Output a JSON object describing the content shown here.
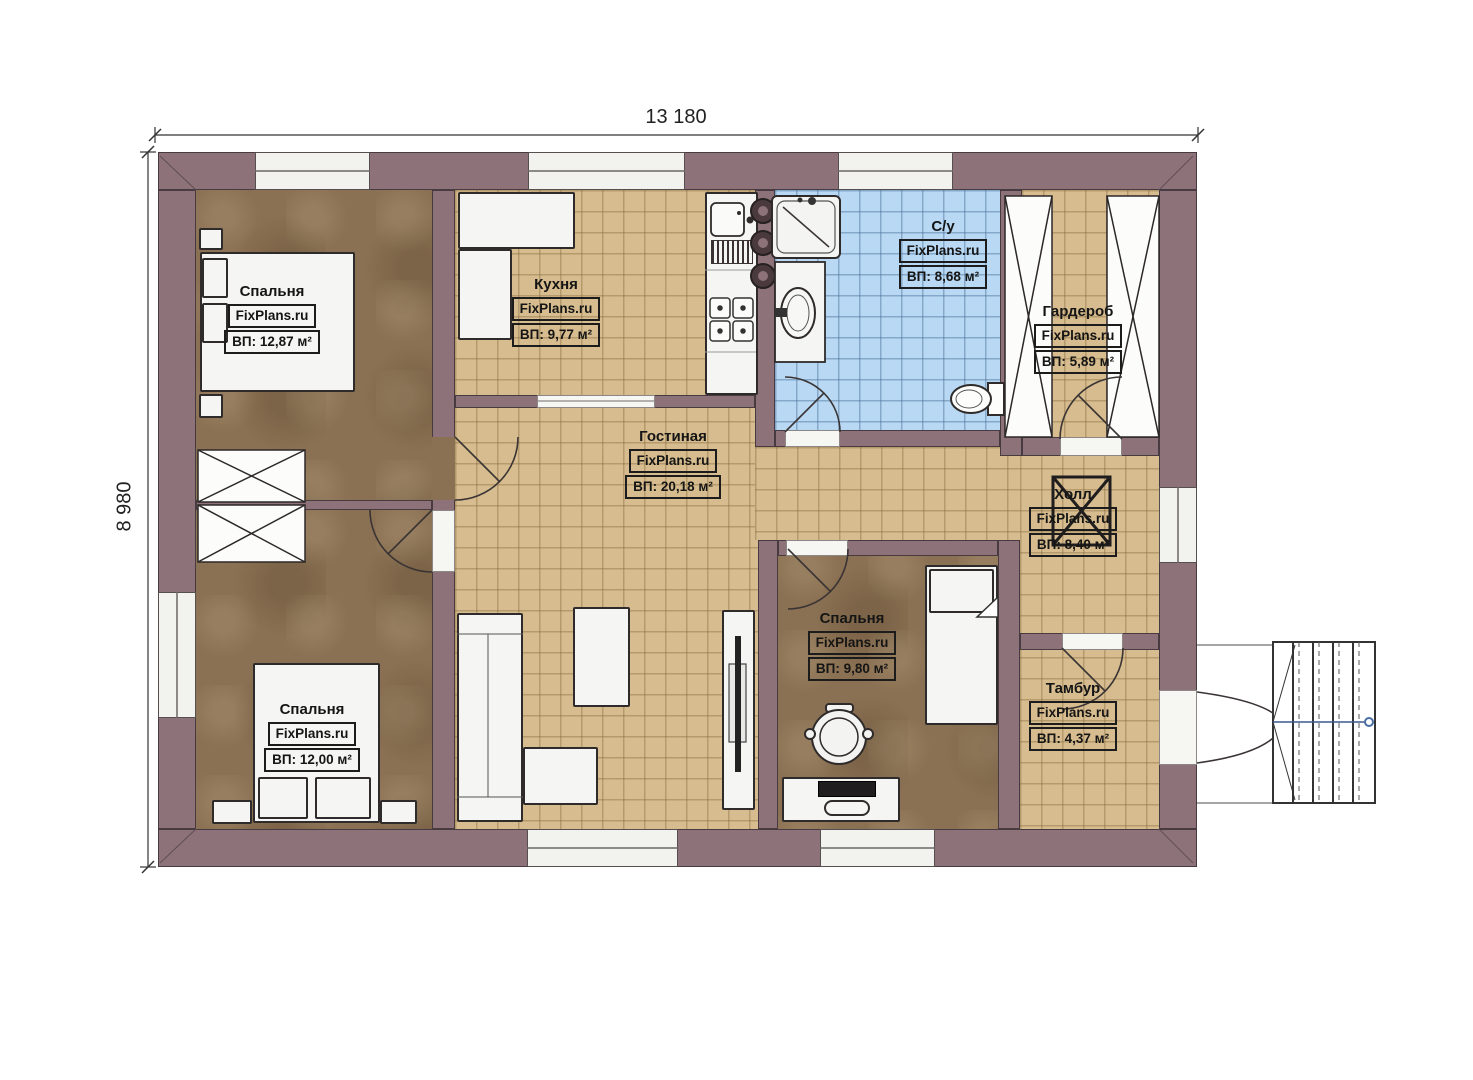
{
  "watermark": "FixPlans.ru",
  "dimensions": {
    "width": "13 180",
    "height": "8 980"
  },
  "rooms": [
    {
      "key": "bedroom-1",
      "name": "Спальня",
      "area": "ВП: 12,87 м²"
    },
    {
      "key": "kitchen",
      "name": "Кухня",
      "area": "ВП: 9,77 м²"
    },
    {
      "key": "bathroom",
      "name": "С/у",
      "area": "ВП: 8,68 м²"
    },
    {
      "key": "wardrobe",
      "name": "Гардероб",
      "area": "ВП: 5,89 м²"
    },
    {
      "key": "living-room",
      "name": "Гостиная",
      "area": "ВП: 20,18 м²"
    },
    {
      "key": "hall",
      "name": "Холл",
      "area": "ВП: 8,40 м²"
    },
    {
      "key": "bedroom-2",
      "name": "Спальня",
      "area": "ВП: 9,80 м²"
    },
    {
      "key": "bedroom-3",
      "name": "Спальня",
      "area": "ВП: 12,00 м²"
    },
    {
      "key": "tambour",
      "name": "Тамбур",
      "area": "ВП: 4,37 м²"
    }
  ],
  "colors": {
    "wall": "#8d7379",
    "bedroom_floor": "#8b7153",
    "tile_floor": "#d6bc8e",
    "bathroom_floor": "#b9d8f3",
    "stair_accent": "#4a6fa5"
  }
}
